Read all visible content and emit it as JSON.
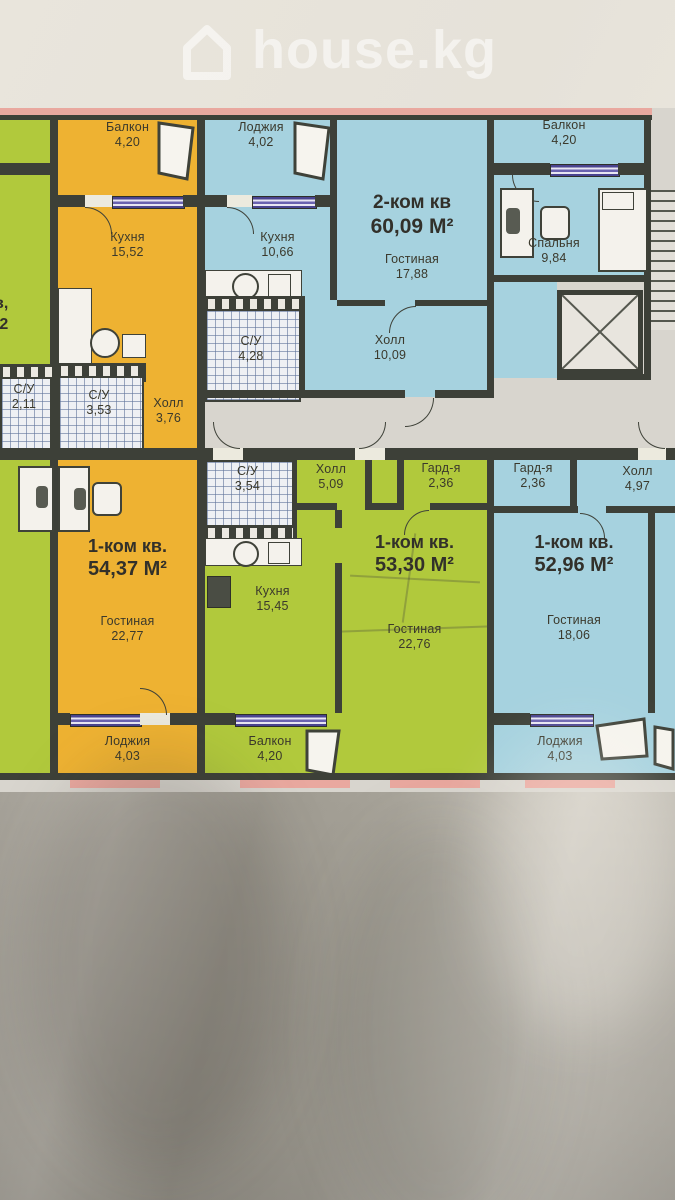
{
  "watermark": {
    "brand": "house.kg"
  },
  "floor_plan": {
    "colors": {
      "orange": "#eeb232",
      "blue": "#a6d2df",
      "green": "#b1c93c",
      "wall": "#3d4038",
      "exterior_pink": "#e9a89f",
      "window_purple": "#5d54a4",
      "corridor": "#d8d5ce"
    },
    "apartments": {
      "left_partial": {
        "unit_line1": "кв,",
        "unit_line2": "М2",
        "wc_name": "С/У",
        "wc_area": "2,11"
      },
      "orange_54": {
        "balcony_name": "Балкон",
        "balcony_area": "4,20",
        "kitchen_name": "Кухня",
        "kitchen_area": "15,52",
        "wc_name": "С/У",
        "wc_area": "3,53",
        "hall_name": "Холл",
        "hall_area": "3,76",
        "unit_type": "1-ком кв.",
        "unit_area": "54,37 М²",
        "living_name": "Гостиная",
        "living_area": "22,77",
        "loggia_name": "Лоджия",
        "loggia_area": "4,03"
      },
      "blue_60": {
        "loggia_name": "Лоджия",
        "loggia_area": "4,02",
        "kitchen_name": "Кухня",
        "kitchen_area": "10,66",
        "wc_name": "С/У",
        "wc_area": "4,28",
        "unit_type": "2-ком кв",
        "unit_area": "60,09 М²",
        "living_name": "Гостиная",
        "living_area": "17,88",
        "hall_name": "Холл",
        "hall_area": "10,09",
        "bedroom_name": "Спальня",
        "bedroom_area": "9,84",
        "balcony_name": "Балкон",
        "balcony_area": "4,20"
      },
      "green_53": {
        "wc_name": "С/У",
        "wc_area": "3,54",
        "hall_name": "Холл",
        "hall_area": "5,09",
        "wardrobe_name": "Гард-я",
        "wardrobe_area": "2,36",
        "kitchen_name": "Кухня",
        "kitchen_area": "15,45",
        "unit_type": "1-ком кв.",
        "unit_area": "53,30 М²",
        "living_name": "Гостиная",
        "living_area": "22,76",
        "balcony_name": "Балкон",
        "balcony_area": "4,20"
      },
      "blue_52": {
        "wardrobe_name": "Гард-я",
        "wardrobe_area": "2,36",
        "hall_name": "Холл",
        "hall_area": "4,97",
        "unit_type": "1-ком кв.",
        "unit_area": "52,96 М²",
        "living_name": "Гостиная",
        "living_area": "18,06",
        "loggia_name": "Лоджия",
        "loggia_area": "4,03"
      }
    }
  }
}
